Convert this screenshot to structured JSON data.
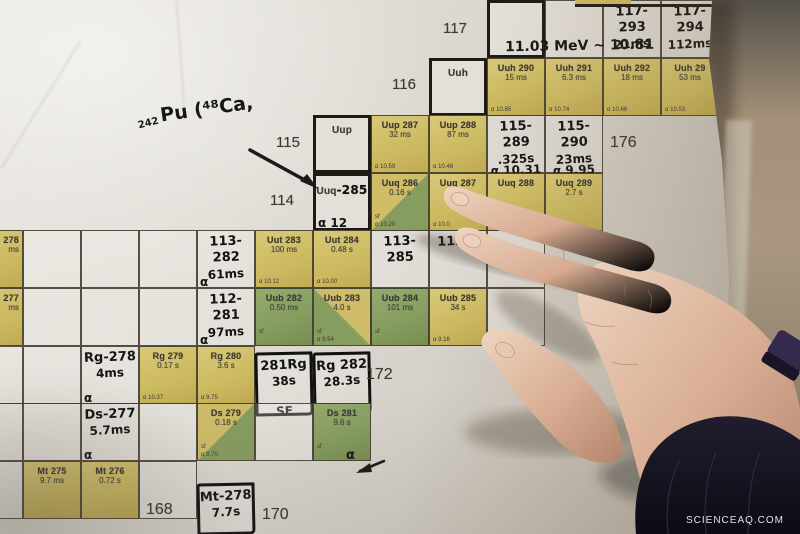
{
  "scene": {
    "description": "Photograph of a printed chart of superheavy nuclides with handwritten isotope annotations; a hand points at element 114 (Uuq) cells.",
    "watermark": "SCIENCEAQ.COM"
  },
  "palette": {
    "cell_yellow": "#cdbb62",
    "cell_green": "#869d60",
    "paper": "#d8d4cd",
    "table": "#a29178",
    "sleeve": "#15141f",
    "handwriting_ink": "#131313",
    "printed_ink": "#3e3b33"
  },
  "layout": {
    "x0": 23,
    "colW": 58,
    "rowH": 57.6,
    "zTop": 117,
    "nBase": 166
  },
  "z_labels": [
    {
      "z": 117,
      "text": "117",
      "x": 443,
      "y": 20
    },
    {
      "z": 116,
      "text": "116",
      "x": 392,
      "y": 76
    },
    {
      "z": 115,
      "text": "115",
      "x": 276,
      "y": 134
    },
    {
      "z": 114,
      "text": "114",
      "x": 270,
      "y": 192
    }
  ],
  "n_labels": [
    {
      "text": "176",
      "x": 610,
      "y": 134
    },
    {
      "text": "172",
      "x": 366,
      "y": 366
    },
    {
      "text": "168",
      "x": 146,
      "y": 501
    },
    {
      "text": "170",
      "x": 262,
      "y": 506
    }
  ],
  "annotations": [
    {
      "name": "pu-242",
      "text": "242",
      "x": 138,
      "y": 118,
      "size": 10,
      "rot": -14
    },
    {
      "name": "pu-reaction",
      "text": "Pu (⁴⁸Ca,",
      "x": 160,
      "y": 98,
      "size": 19,
      "rot": -8
    },
    {
      "name": "mev-chain",
      "text": "11.03 MeV ~ 10.81",
      "x": 505,
      "y": 38,
      "size": 14,
      "rot": -1
    },
    {
      "name": "ds281-alpha",
      "text": "α",
      "x": 346,
      "y": 448,
      "size": 13,
      "rot": 0
    }
  ],
  "cells": [
    {
      "z": 117,
      "n": 174,
      "kind": "element",
      "title": ""
    },
    {
      "z": 117,
      "n": 175,
      "kind": "white"
    },
    {
      "z": 117,
      "n": 176,
      "kind": "whitehw",
      "hw": [
        "117-293",
        "21ms"
      ]
    },
    {
      "z": 117,
      "n": 177,
      "kind": "whitehw",
      "hw": [
        "117-294",
        "112ms"
      ]
    },
    {
      "z": 116,
      "n": 173,
      "kind": "element",
      "title": "Uuh"
    },
    {
      "z": 116,
      "n": 174,
      "kind": "yellow",
      "title": "Uuh 290",
      "sub": "15 ms",
      "alpha": "α 10.85"
    },
    {
      "z": 116,
      "n": 175,
      "kind": "yellow",
      "title": "Uuh 291",
      "sub": "6.3 ms",
      "alpha": "α 10.74"
    },
    {
      "z": 116,
      "n": 176,
      "kind": "yellow",
      "title": "Uuh 292",
      "sub": "18 ms",
      "alpha": "α 10.66"
    },
    {
      "z": 116,
      "n": 177,
      "kind": "yellow",
      "title": "Uuh 29",
      "sub": "53 ms",
      "alpha": "α 10.53"
    },
    {
      "z": 115,
      "n": 171,
      "kind": "element",
      "title": "Uup"
    },
    {
      "z": 115,
      "n": 172,
      "kind": "yellow",
      "title": "Uup 287",
      "sub": "32 ms",
      "alpha": "α 10.59"
    },
    {
      "z": 115,
      "n": 173,
      "kind": "yellow",
      "title": "Uup 288",
      "sub": "87 ms",
      "alpha": "α 10.46"
    },
    {
      "z": 115,
      "n": 174,
      "kind": "whitehw",
      "hw": [
        "115-289",
        ".325s",
        "α 10.31"
      ]
    },
    {
      "z": 115,
      "n": 175,
      "kind": "whitehw",
      "hw": [
        "115-290",
        "23ms",
        "α 9.95"
      ]
    },
    {
      "z": 114,
      "n": 171,
      "kind": "element",
      "title": "Uuq",
      "hwsuffix": "-285",
      "corner": "α 12"
    },
    {
      "z": 114,
      "n": 172,
      "kind": "split-br",
      "title": "Uuq 286",
      "sub": "0.16 s",
      "sf": "sf",
      "alpha": "α 10.20"
    },
    {
      "z": 114,
      "n": 173,
      "kind": "yellow",
      "title": "Uuq 287",
      "sub": "0.51 s",
      "alpha": "α 10.0"
    },
    {
      "z": 114,
      "n": 174,
      "kind": "yellow",
      "title": "Uuq 288",
      "sub": "",
      "alpha": "α 9.95"
    },
    {
      "z": 114,
      "n": 175,
      "kind": "yellow",
      "title": "Uuq 289",
      "sub": "2.7 s",
      "alpha": ""
    },
    {
      "z": 113,
      "n": 165,
      "kind": "yellow",
      "title": "278",
      "sub": "ms",
      "align": "right"
    },
    {
      "z": 113,
      "n": 166,
      "kind": "white"
    },
    {
      "z": 113,
      "n": 167,
      "kind": "white"
    },
    {
      "z": 113,
      "n": 168,
      "kind": "white"
    },
    {
      "z": 113,
      "n": 169,
      "kind": "whitehw",
      "hw": [
        "113-282",
        "61ms"
      ],
      "corner": "α"
    },
    {
      "z": 113,
      "n": 170,
      "kind": "yellow",
      "title": "Uut 283",
      "sub": "100 ms",
      "alpha": "α 10.12"
    },
    {
      "z": 113,
      "n": 171,
      "kind": "yellow",
      "title": "Uut 284",
      "sub": "0.48 s",
      "alpha": "α 10.00"
    },
    {
      "z": 113,
      "n": 172,
      "kind": "whitehw",
      "hw": [
        "113-285"
      ]
    },
    {
      "z": 113,
      "n": 173,
      "kind": "whitehw",
      "hw": [
        "113-2"
      ]
    },
    {
      "z": 113,
      "n": 174,
      "kind": "white"
    },
    {
      "z": 112,
      "n": 165,
      "kind": "yellow",
      "title": "277",
      "sub": "ms",
      "align": "right"
    },
    {
      "z": 112,
      "n": 166,
      "kind": "white"
    },
    {
      "z": 112,
      "n": 167,
      "kind": "white"
    },
    {
      "z": 112,
      "n": 168,
      "kind": "white"
    },
    {
      "z": 112,
      "n": 169,
      "kind": "whitehw",
      "hw": [
        "112-281",
        "97ms"
      ],
      "corner": "α"
    },
    {
      "z": 112,
      "n": 170,
      "kind": "green",
      "title": "Uub 282",
      "sub": "0.50 ms",
      "sf": "sf"
    },
    {
      "z": 112,
      "n": 171,
      "kind": "split-bl",
      "title": "Uub 283",
      "sub": "4.0 s",
      "sf": "sf",
      "alpha": "α 9.54"
    },
    {
      "z": 112,
      "n": 172,
      "kind": "green",
      "title": "Uub 284",
      "sub": "101 ms",
      "sf": "sf"
    },
    {
      "z": 112,
      "n": 173,
      "kind": "yellow",
      "title": "Uub 285",
      "sub": "34 s",
      "alpha": "α 9.16"
    },
    {
      "z": 112,
      "n": 174,
      "kind": "white"
    },
    {
      "z": 111,
      "n": 165,
      "kind": "white"
    },
    {
      "z": 111,
      "n": 166,
      "kind": "white"
    },
    {
      "z": 111,
      "n": 167,
      "kind": "whitehw",
      "hw": [
        "Rg-278",
        "4ms"
      ],
      "corner": "α"
    },
    {
      "z": 111,
      "n": 168,
      "kind": "yellow",
      "title": "Rg 279",
      "sub": "0.17 s",
      "alpha": "α 10.37"
    },
    {
      "z": 111,
      "n": 169,
      "kind": "yellow",
      "title": "Rg 280",
      "sub": "3.6 s",
      "alpha": "α 9.75"
    },
    {
      "z": 111,
      "n": 170,
      "kind": "hwbox",
      "hw": [
        "281Rg",
        "38s",
        "SF"
      ],
      "dy": 6,
      "h": 64
    },
    {
      "z": 111,
      "n": 171,
      "kind": "hwbox",
      "hw": [
        "Rg 282",
        "28.3s",
        "α 9.83"
      ],
      "dy": 6,
      "h": 62
    },
    {
      "z": 110,
      "n": 165,
      "kind": "white"
    },
    {
      "z": 110,
      "n": 166,
      "kind": "white"
    },
    {
      "z": 110,
      "n": 167,
      "kind": "whitehw",
      "hw": [
        "Ds-277",
        "5.7ms"
      ],
      "corner": "α"
    },
    {
      "z": 110,
      "n": 168,
      "kind": "white"
    },
    {
      "z": 110,
      "n": 169,
      "kind": "split-br",
      "title": "Ds 279",
      "sub": "0.18 s",
      "sf": "sf",
      "alpha": "α 9.70"
    },
    {
      "z": 110,
      "n": 170,
      "kind": "white"
    },
    {
      "z": 110,
      "n": 171,
      "kind": "green",
      "title": "Ds 281",
      "sub": "9.6 s",
      "sf": "sf"
    },
    {
      "z": 109,
      "n": 165,
      "kind": "white"
    },
    {
      "z": 109,
      "n": 166,
      "kind": "yellow",
      "title": "Mt 275",
      "sub": "9.7 ms"
    },
    {
      "z": 109,
      "n": 167,
      "kind": "yellow",
      "title": "Mt 276",
      "sub": "0.72 s"
    },
    {
      "z": 109,
      "n": 168,
      "kind": "white"
    },
    {
      "z": 109,
      "n": 169,
      "kind": "hwbox",
      "hw": [
        "Mt-278",
        "7.7s"
      ],
      "dy": 22,
      "h": 52
    }
  ]
}
